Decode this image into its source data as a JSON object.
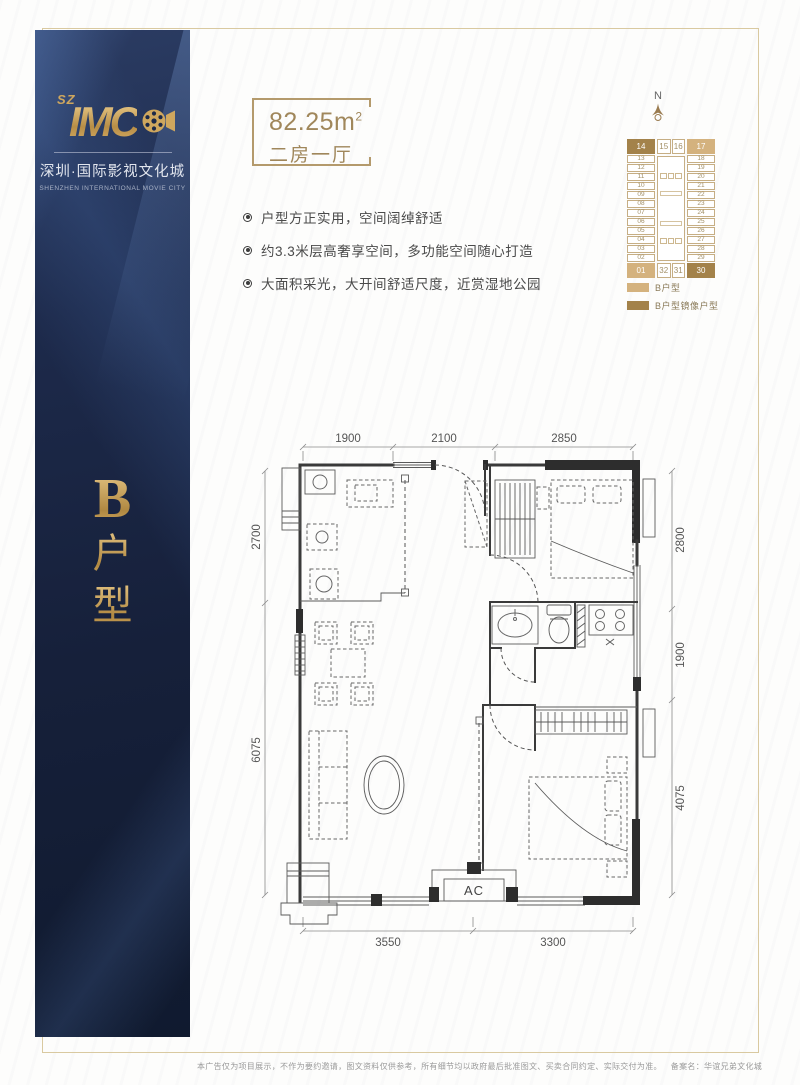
{
  "brand": {
    "sz": "SZ",
    "name": "IMC",
    "cn": "深圳·国际影视文化城",
    "en": "SHENZHEN INTERNATIONAL MOVIE CITY"
  },
  "sidebar": {
    "unit_letter": "B",
    "unit_char_1": "户",
    "unit_char_2": "型"
  },
  "unit_info": {
    "area_value": "82.25m",
    "area_sup": "2",
    "layout": "二房一厅"
  },
  "features": [
    "户型方正实用，空间阔绰舒适",
    "约3.3米层高奢享空间，多功能空间随心打造",
    "大面积采光，大开间舒适尺度，近赏湿地公园"
  ],
  "compass": {
    "north": "N"
  },
  "stack": {
    "left_units": [
      "14",
      "13",
      "12",
      "11",
      "10",
      "09",
      "08",
      "07",
      "06",
      "05",
      "04",
      "03",
      "02",
      "01"
    ],
    "right_units": [
      "17",
      "18",
      "19",
      "20",
      "21",
      "22",
      "23",
      "24",
      "25",
      "26",
      "27",
      "28",
      "29",
      "30"
    ],
    "mid_top": [
      "15",
      "16"
    ],
    "mid_bottom": [
      "32",
      "31"
    ],
    "b_units": [
      "01",
      "17"
    ],
    "mirror_units": [
      "14",
      "30"
    ],
    "colors": {
      "b": "#d4b27e",
      "mirror": "#a3824a"
    },
    "legend": [
      {
        "type": "b",
        "label": "B户型"
      },
      {
        "type": "mirror",
        "label": "B户型镜像户型"
      }
    ]
  },
  "floor_plan": {
    "dims_top": [
      "1900",
      "2100",
      "2850"
    ],
    "dims_left": [
      "2700",
      "6075"
    ],
    "dims_right": [
      "2800",
      "1900",
      "4075"
    ],
    "dims_bottom": [
      "3550",
      "3300"
    ],
    "ac_label": "AC"
  },
  "footer": {
    "disclaimer": "本广告仅为项目展示，不作为要约邀请，图文资料仅供参考，所有细节均以政府最后批准图文、买卖合同约定、实际交付为准。",
    "filing": "备案名：华谊兄弟文化城"
  }
}
